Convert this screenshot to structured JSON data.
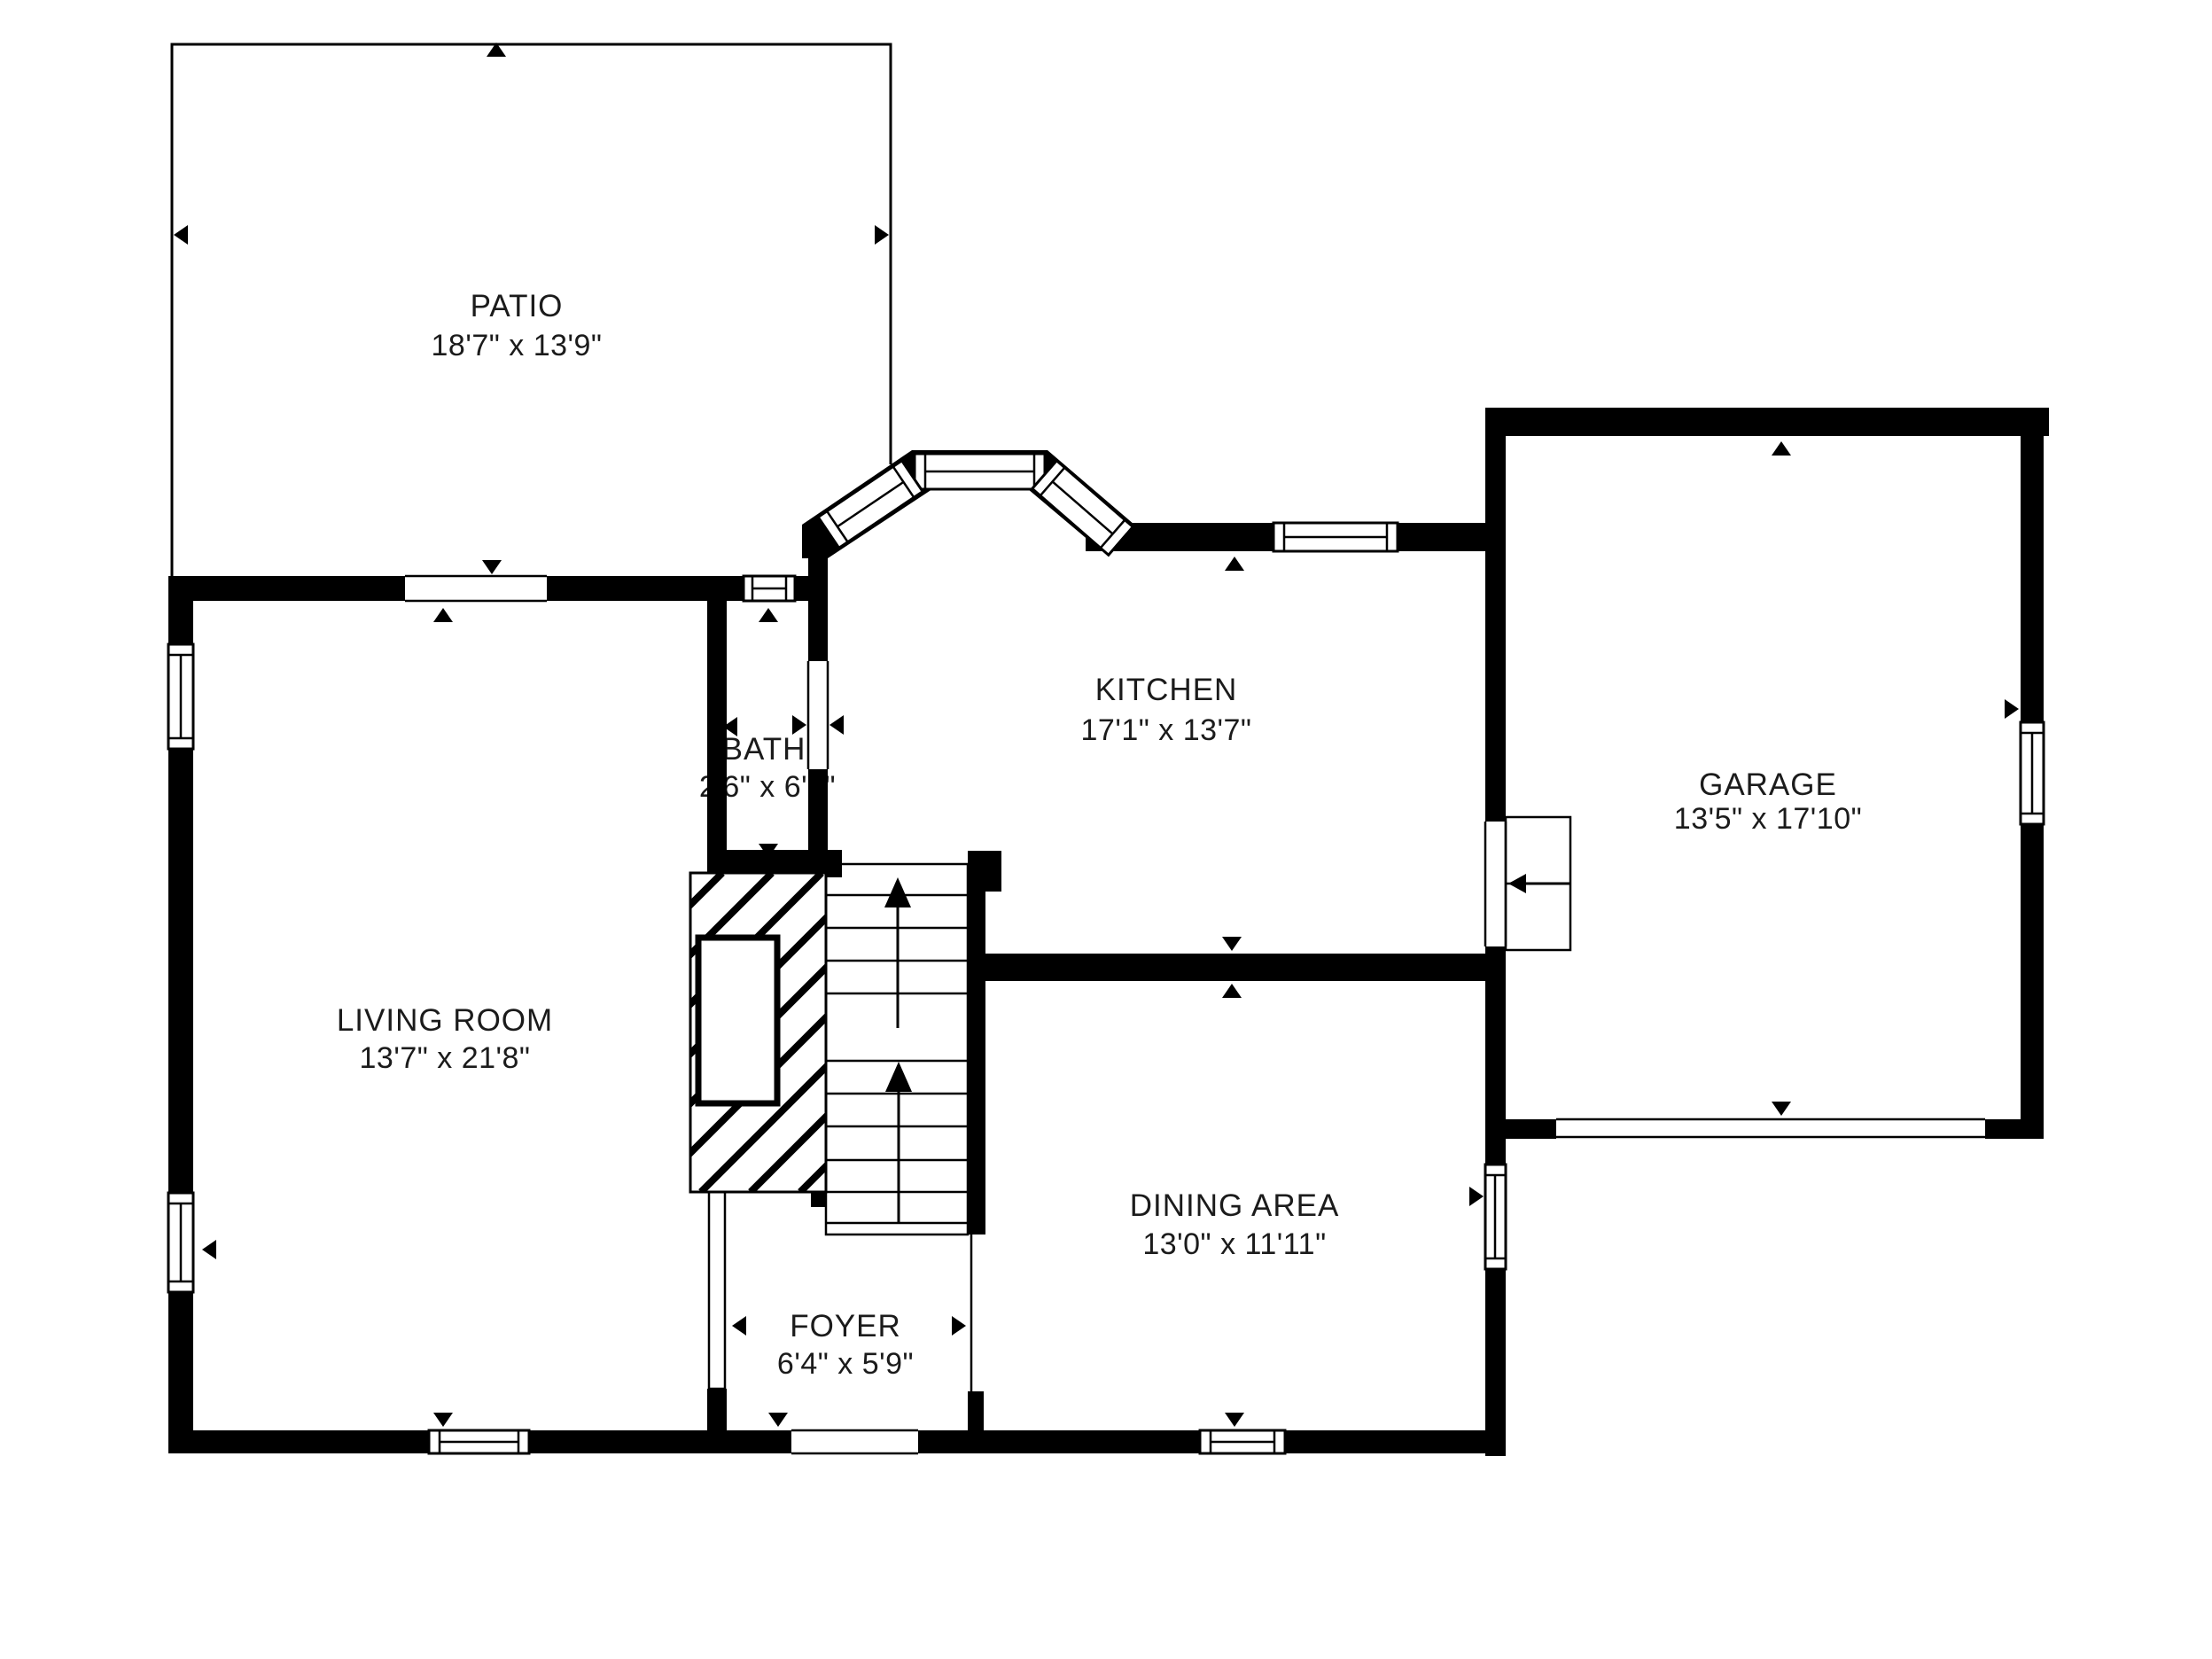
{
  "page": {
    "background_color": "#ffffff",
    "wall_color": "#000000",
    "text_color": "#1b1b1b",
    "type": "floor-plan"
  },
  "rooms": [
    {
      "id": "patio",
      "name": "PATIO",
      "dims": "18'7\" x 13'9\""
    },
    {
      "id": "kitchen",
      "name": "KITCHEN",
      "dims": "17'1\" x 13'7\""
    },
    {
      "id": "garage",
      "name": "GARAGE",
      "dims": "13'5\" x 17'10\""
    },
    {
      "id": "bath",
      "name": "BATH",
      "dims": "2'6\" x 6'8\""
    },
    {
      "id": "living_room",
      "name": "LIVING ROOM",
      "dims": "13'7\" x 21'8\""
    },
    {
      "id": "dining_area",
      "name": "DINING AREA",
      "dims": "13'0\" x 11'11\""
    },
    {
      "id": "foyer",
      "name": "FOYER",
      "dims": "6'4\" x 5'9\""
    }
  ]
}
